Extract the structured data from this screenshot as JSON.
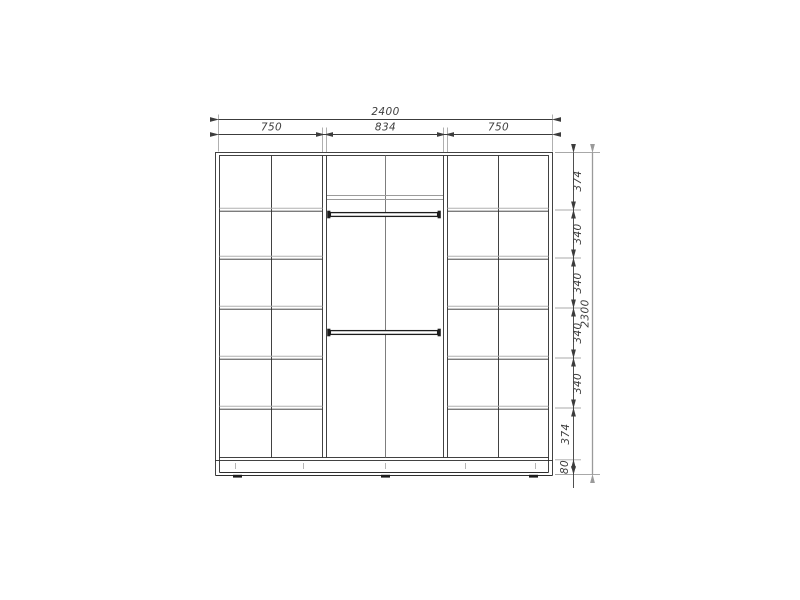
{
  "drawing": {
    "title": "Wardrobe front elevation blueprint",
    "top_dimensions": {
      "overall": "2400",
      "sections": [
        "750",
        "834",
        "750"
      ]
    },
    "right_dimensions": {
      "rows": [
        "374",
        "340",
        "340",
        "340",
        "340",
        "374"
      ],
      "base_height": "80",
      "overall": "2300"
    },
    "sections": {
      "left": {
        "width": "750",
        "layout": "2 columns x 6 shelf rows"
      },
      "middle": {
        "width": "834",
        "layout": "top shelf row with center divider, upper hanging rod, lower hanging rod, open hanging space"
      },
      "right": {
        "width": "750",
        "layout": "2 columns x 6 shelf rows"
      }
    },
    "base": {
      "type": "plinth with adjustable feet"
    },
    "colors": {
      "background": "#ffffff",
      "line_dark": "#2e2e2e",
      "line_gray": "#a8a8a8",
      "dimension_text": "#3e3e3e"
    }
  }
}
